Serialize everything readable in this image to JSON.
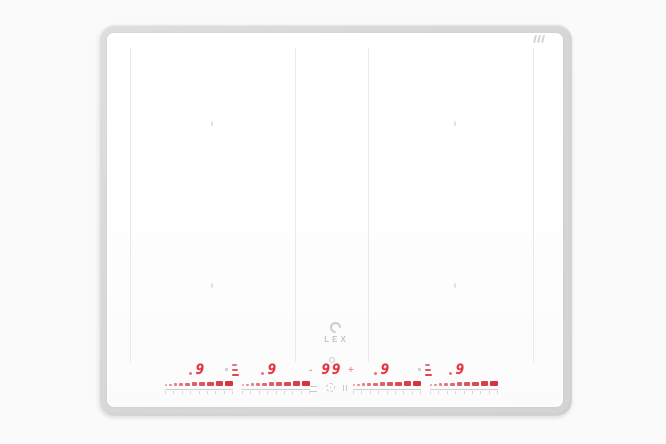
{
  "product": {
    "brand": "LEX",
    "kind": "induction cooktop"
  },
  "logo": {
    "text": "LEX",
    "mark_icon": "lex-emblem-icon"
  },
  "top_indicator": {
    "icon": "residual-heat-icon"
  },
  "colors": {
    "led_red": "#e0323e",
    "frame_gray": "#d6d8d9",
    "glass_white": "#fdfdfd",
    "divider_gray": "#e9eaea",
    "touch_gray": "#c9cbcc"
  },
  "control_panel": {
    "zones": [
      {
        "id": "zone-left-outer",
        "power_level": "9",
        "max_level": 9,
        "slider_segments": 10
      },
      {
        "id": "zone-left-inner",
        "power_level": "9",
        "max_level": 9,
        "slider_segments": 10
      },
      {
        "id": "zone-right-inner",
        "power_level": "9",
        "max_level": 9,
        "slider_segments": 10
      },
      {
        "id": "zone-right-outer",
        "power_level": "9",
        "max_level": 9,
        "slider_segments": 10
      }
    ],
    "bridge_indicator_count": 2,
    "timer": {
      "value": "99",
      "minus_label": "-",
      "plus_label": "+",
      "clock_icon": "clock-icon"
    },
    "buttons": {
      "menu_icon": "menu-icon",
      "power_icon": "power-icon",
      "pause_icon": "pause-icon"
    }
  }
}
